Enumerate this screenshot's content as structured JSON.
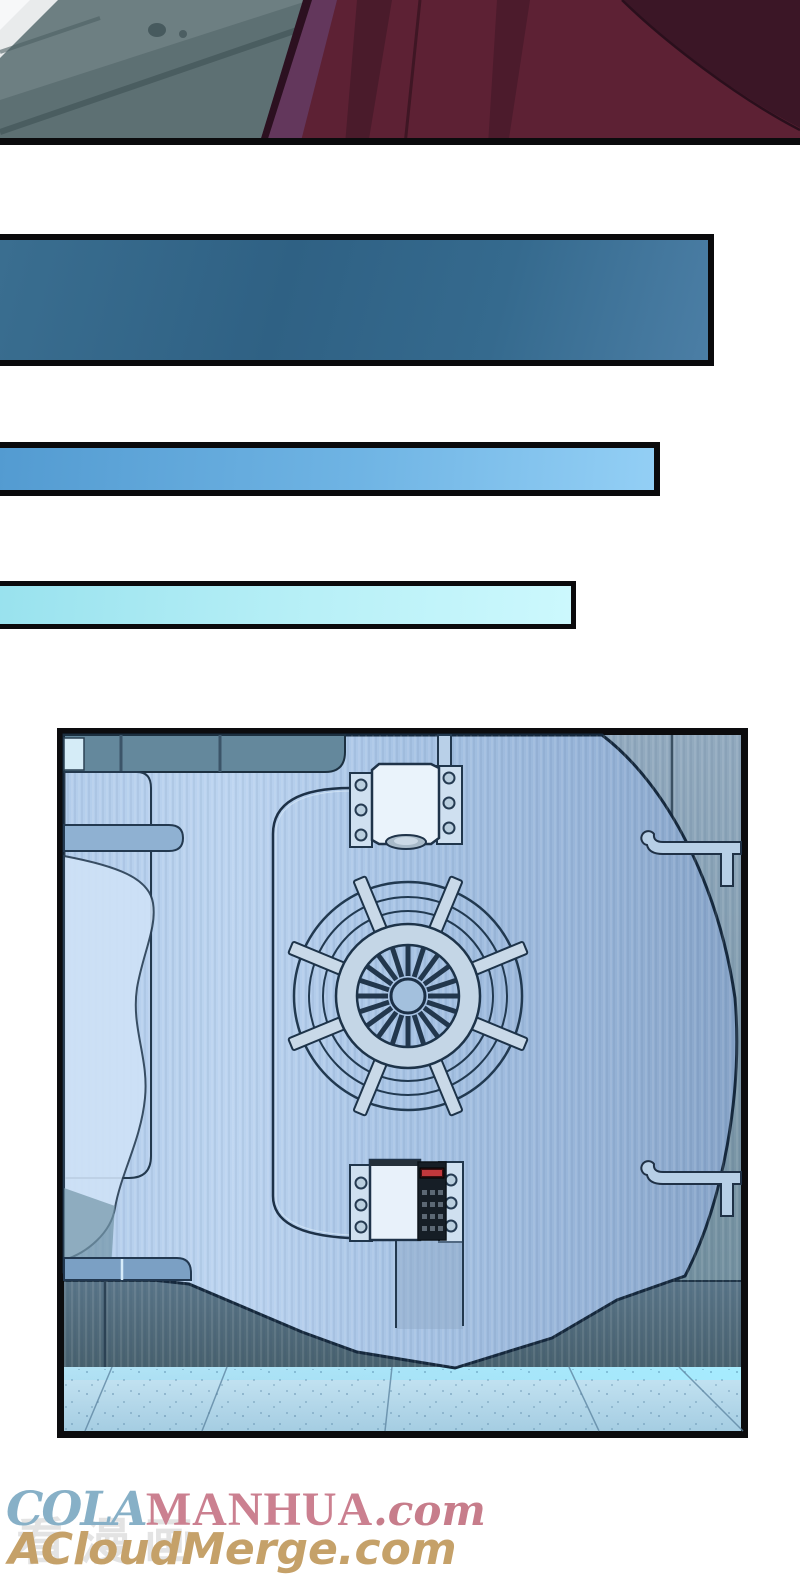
{
  "page": {
    "type": "manhua comic page",
    "background_color": "#ffffff",
    "panels": [
      {
        "id": "panel-top",
        "description": "close-up of a grey tiled floor (left) and a dark red draped garment with folds (right)"
      },
      {
        "id": "caption-bar-1",
        "description": "empty narration bar, dark steel blue",
        "color_left": "#386d90",
        "color_right": "#4e82a8"
      },
      {
        "id": "caption-bar-2",
        "description": "empty narration bar, sky blue",
        "color_left": "#539bd1",
        "color_right": "#93cff5"
      },
      {
        "id": "caption-bar-3",
        "description": "empty narration bar, pale cyan",
        "color_left": "#99e2ee",
        "color_right": "#ccf8fd"
      },
      {
        "id": "panel-vault",
        "description": "large circular metal bank-vault door with spoked wheel, turbine hub, top hinge block, keypad lock with red LED, wall hooks and glowing tiled floor"
      }
    ]
  },
  "watermarks": {
    "site1_script": "COLA",
    "site1_main": "MANHUA",
    "site1_tld": ".com",
    "site1_script_color": "#87b0c7",
    "site1_main_color": "#cb8090",
    "site2": "ACloudMerge.com",
    "site2_color": "#c5a169",
    "site_zh_faint": "看漫画",
    "site_zh_color": "#c9c9c9"
  },
  "vault_colors": {
    "door_steel": "#a8c4e5",
    "wall_right": "#8199ae",
    "lower_wall": "#52707f",
    "floor": "#bfe2f2",
    "floor_glow": "#9ae4fa",
    "keypad_body": "#161e26",
    "keypad_led": "#c1383c",
    "line_ink": "#1d3147"
  }
}
